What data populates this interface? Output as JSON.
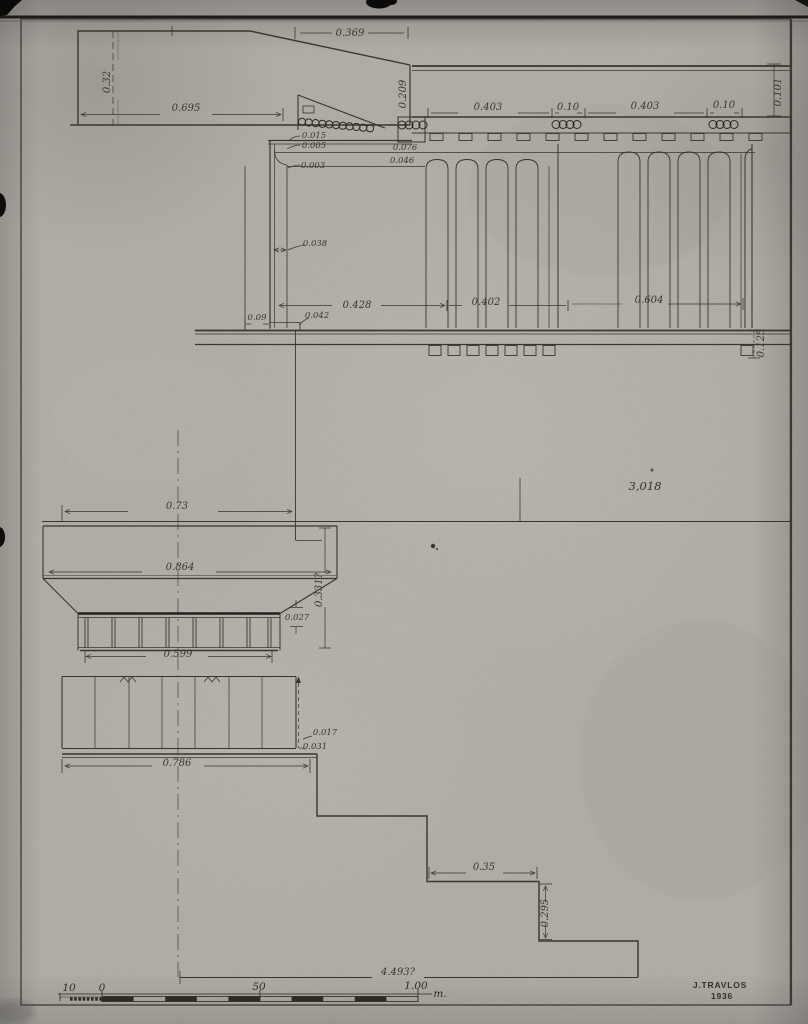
{
  "dims": {
    "d032": "0.32",
    "d0369": "0.369",
    "d0695": "0.695",
    "d0209": "0.209",
    "d0015": "0.015",
    "d0005": "0.005",
    "d0003": "0.003",
    "d0403a": "0.403",
    "d010a": "0.10",
    "d0403b": "0.403",
    "d010b": "0.10",
    "d0101": "0.101",
    "d0076": "0.076",
    "d0046": "0.046",
    "d0038": "0.038",
    "d0428": "0.428",
    "d0402": "0.402",
    "d0604": "0.604",
    "d009": "0.09",
    "d0042": "0.042",
    "d0125": "0.125",
    "d3018": "3,018",
    "d073": "0.73",
    "d0864": "0.864",
    "d0331": "0.331?",
    "d0027": "0.027",
    "d0599": "0.599",
    "d0017": "0.017",
    "d0031": "0.031",
    "d0786": "0.786",
    "d035": "0.35",
    "d0295": "0.295",
    "d4493": "4.493?"
  },
  "scale_bar": {
    "left": "10",
    "zero": "0",
    "mid": "50",
    "right": "1.00",
    "unit": "m."
  },
  "signature": {
    "name": "J.TRAVLOS",
    "year": "1936"
  }
}
